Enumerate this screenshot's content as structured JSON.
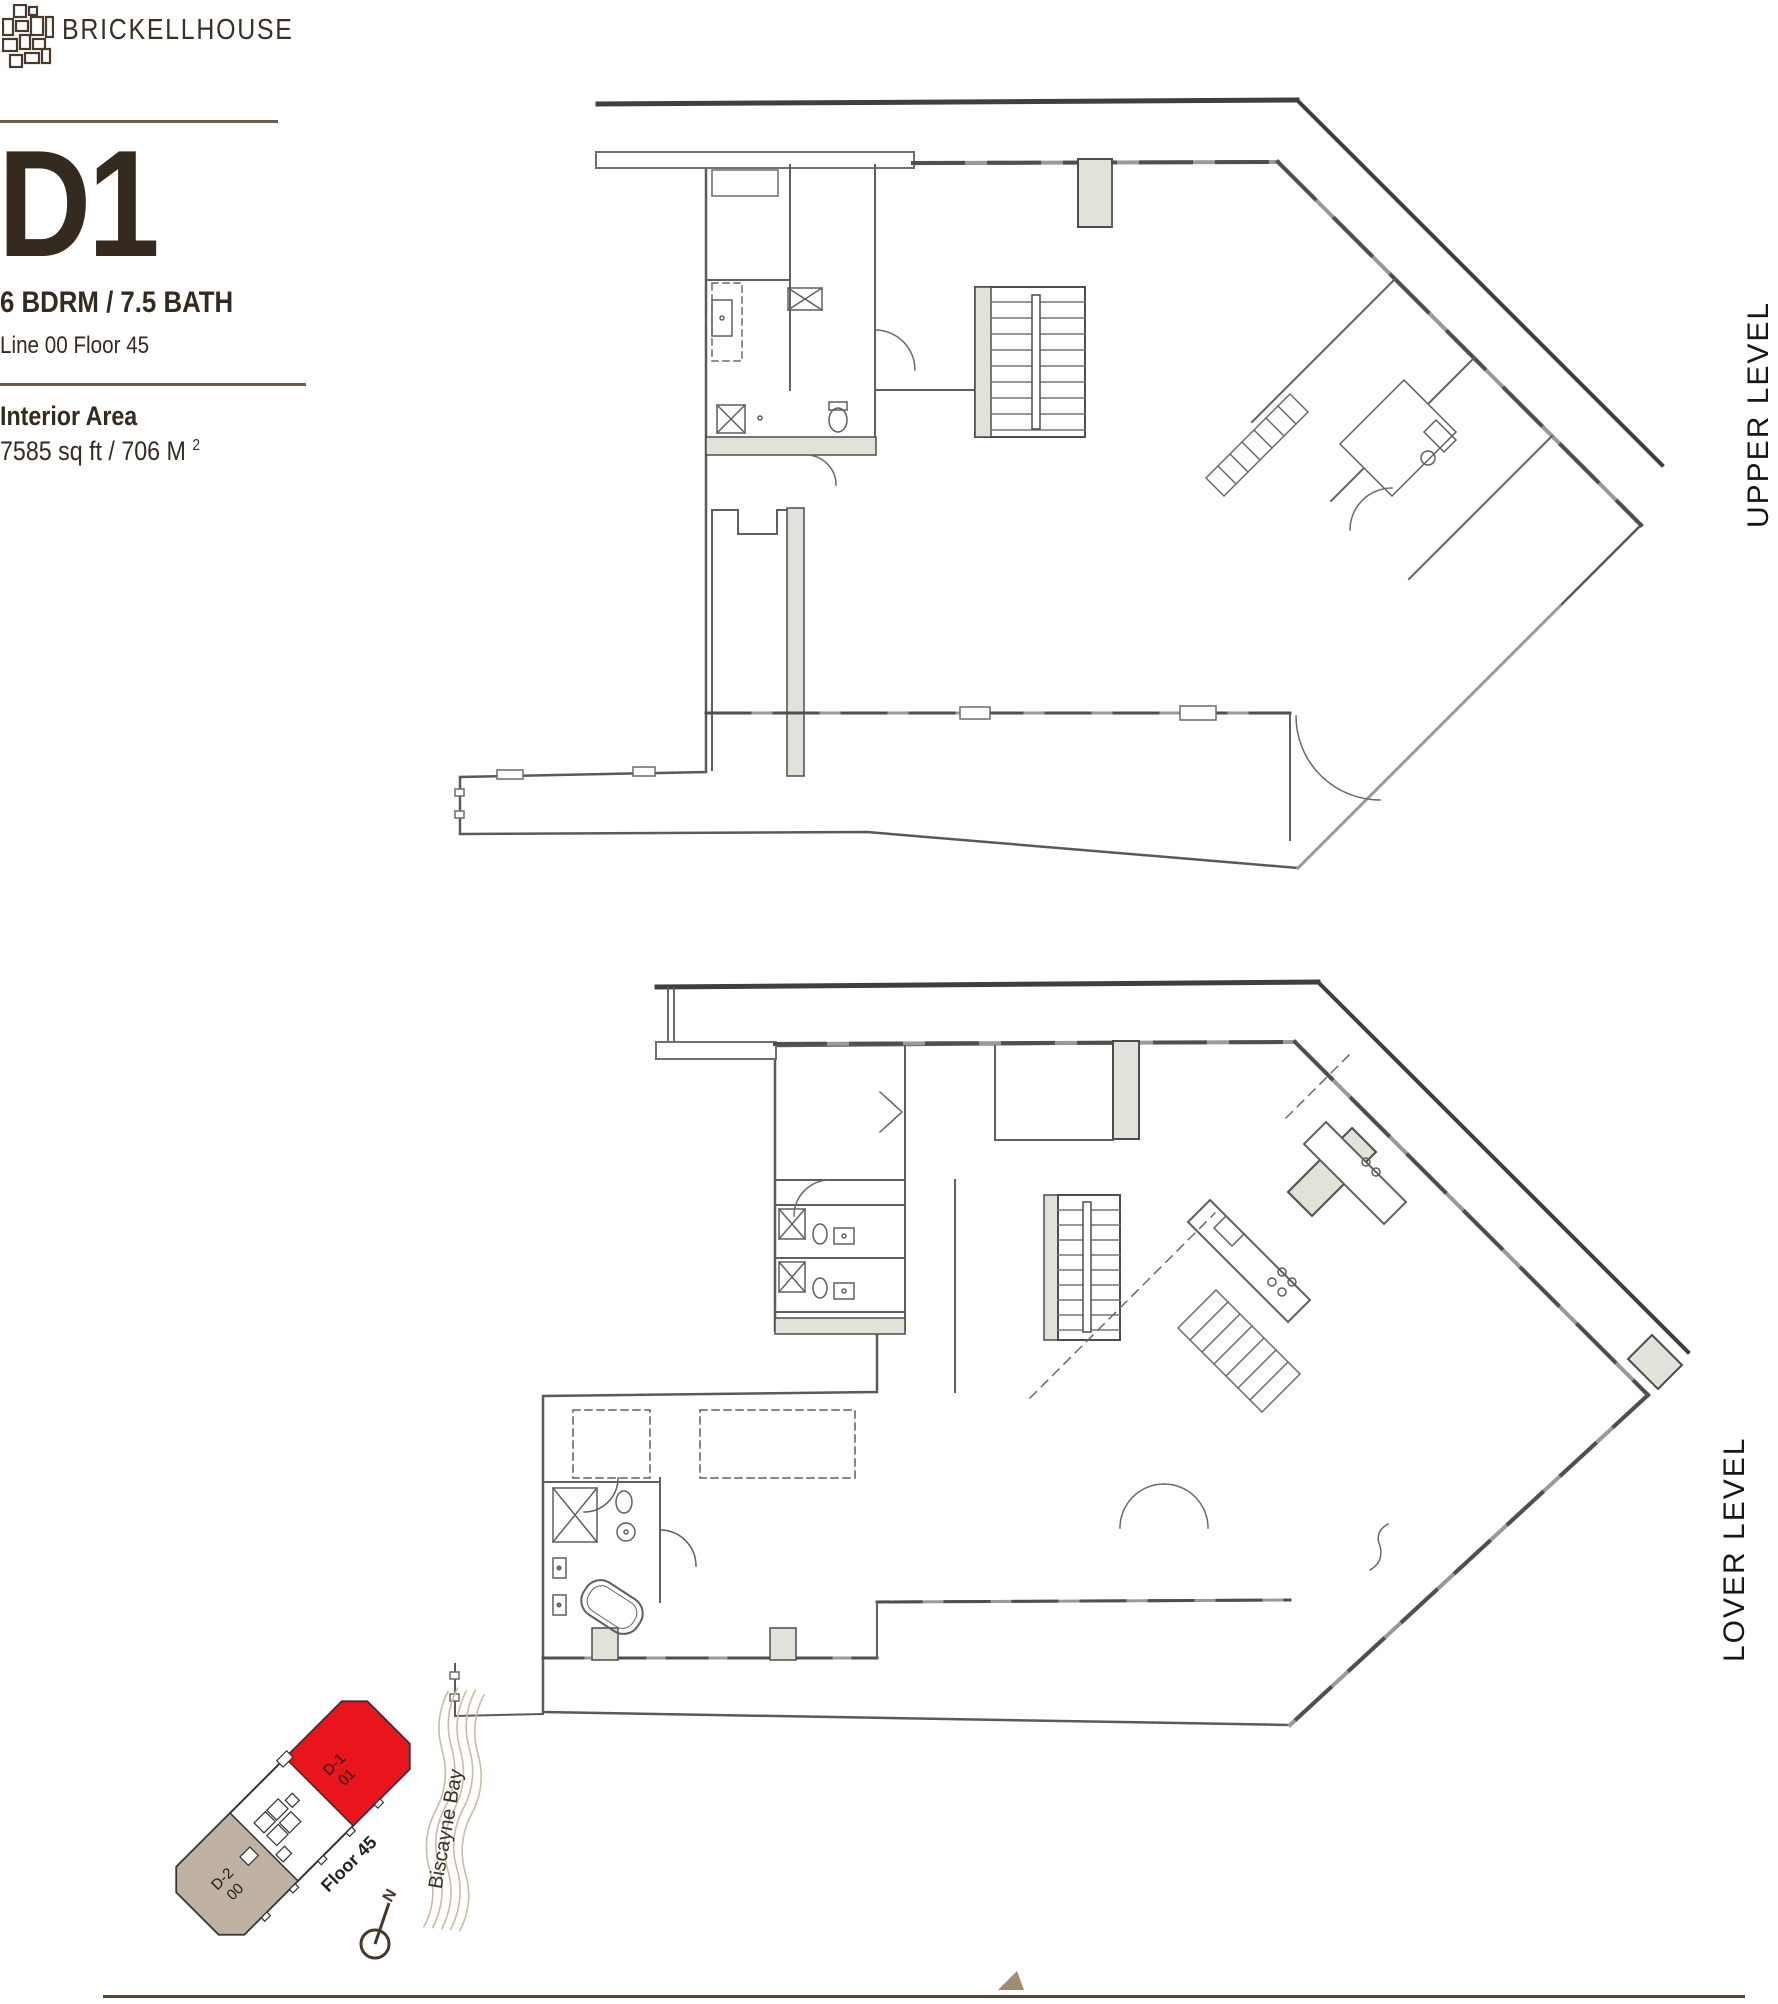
{
  "header": {
    "brand": "BRICKELLHOUSE",
    "unit_id": "D1",
    "specs": "6 BDRM  / 7.5 BATH",
    "line_floor": "Line 00 Floor 45",
    "area_label": "Interior Area",
    "area_value": "7585 sq ft / 706 M ",
    "area_sup": "2"
  },
  "levels": {
    "upper_label": "UPPER LEVEL",
    "lower_label": "LOVER LEVEL"
  },
  "keyplan": {
    "unit1_line1": "D-1",
    "unit1_line2": "01",
    "unit2_line1": "D-2",
    "unit2_line2": "00",
    "floor_label": "Floor 45",
    "bay_label": "Biscayne Bay",
    "compass_n": "N",
    "highlight_color": "#e8151c",
    "secondary_color": "#c0b2a2",
    "accent_brown": "#46362a"
  }
}
